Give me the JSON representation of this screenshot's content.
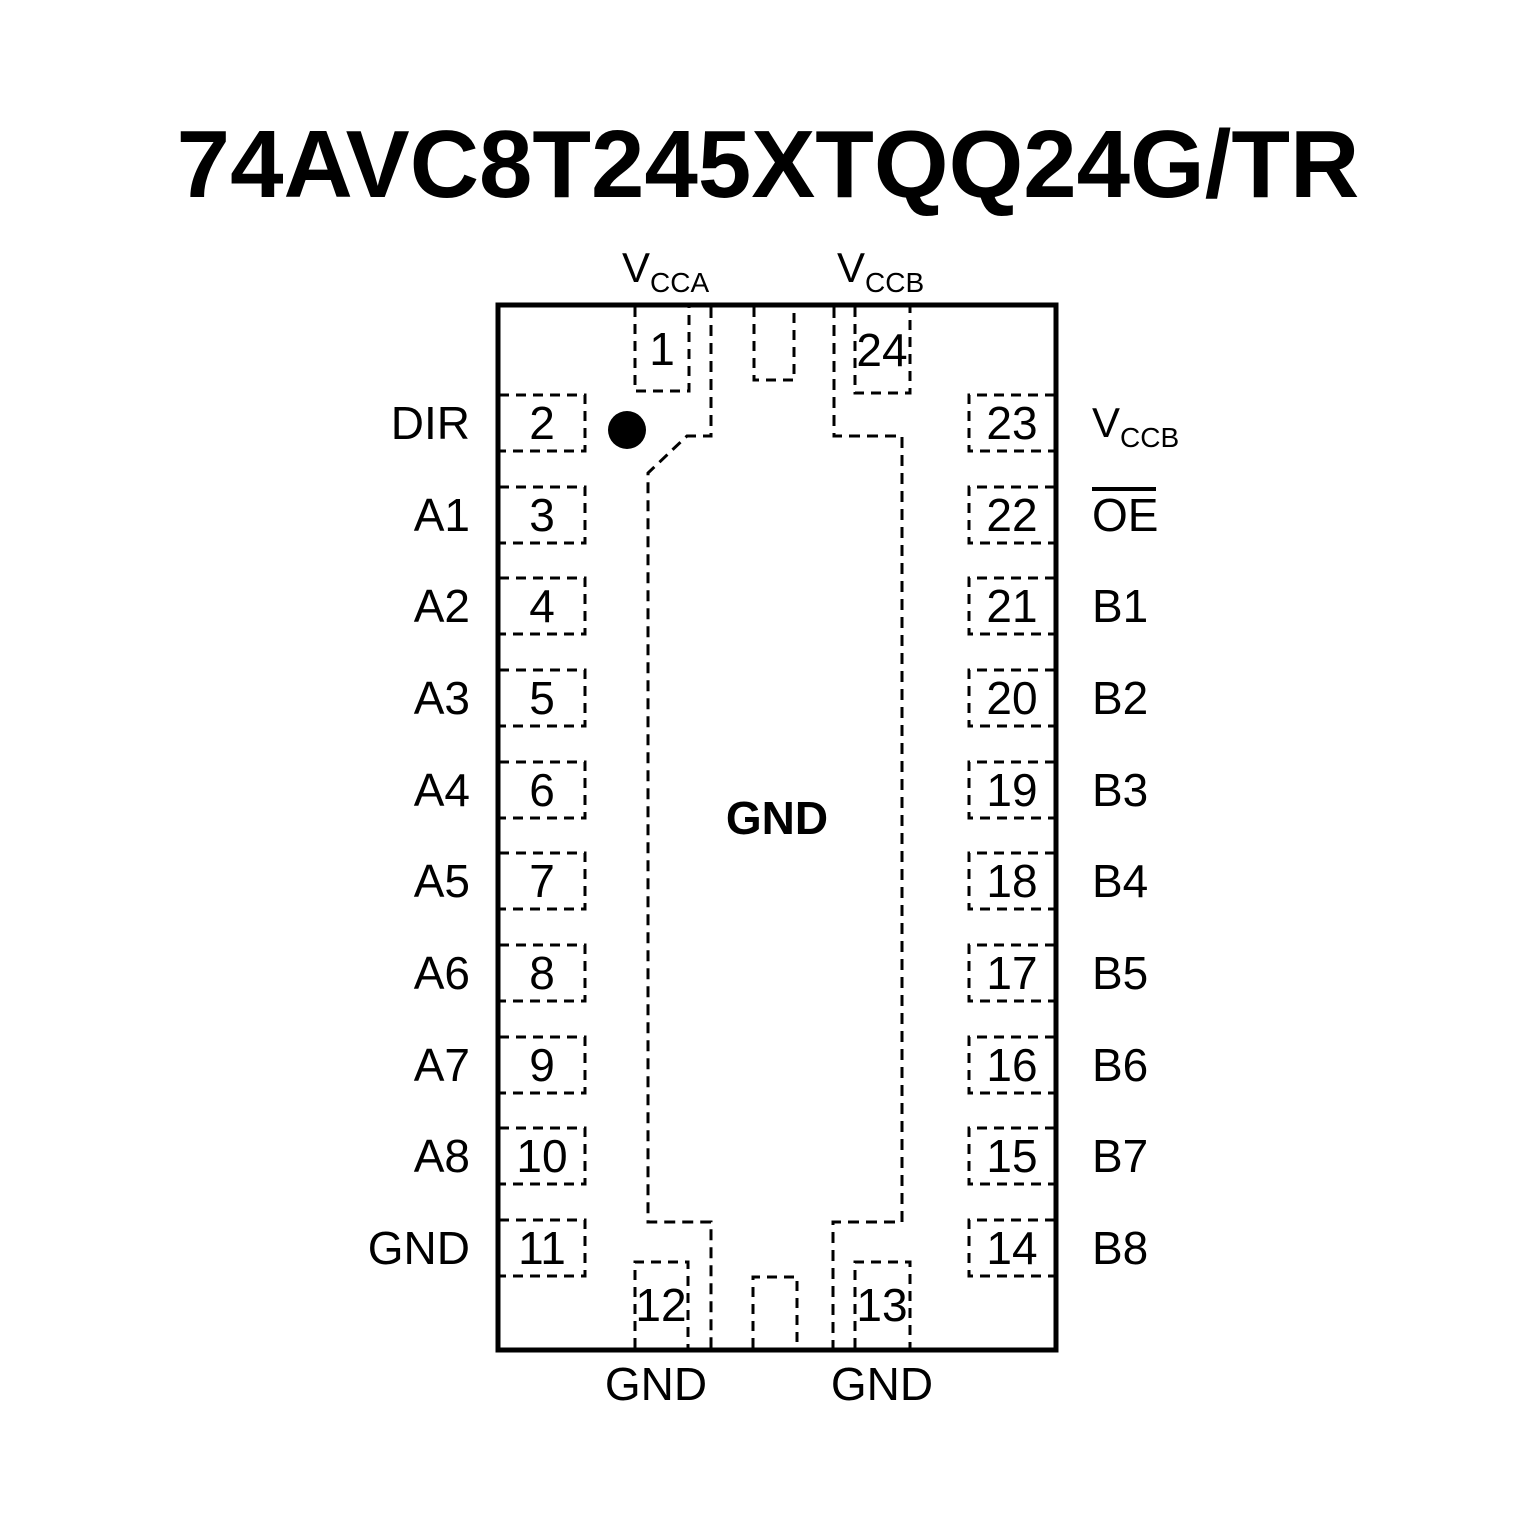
{
  "title": "74AVC8T245XTQQ24G/TR",
  "labels": {
    "vcca_top": {
      "main": "V",
      "sub": "CCA"
    },
    "vccb_top": {
      "main": "V",
      "sub": "CCB"
    },
    "center_pad": "GND"
  },
  "pins": {
    "top": [
      {
        "number": "1"
      },
      {
        "number": "24"
      }
    ],
    "left": [
      {
        "number": "2",
        "label": "DIR"
      },
      {
        "number": "3",
        "label": "A1"
      },
      {
        "number": "4",
        "label": "A2"
      },
      {
        "number": "5",
        "label": "A3"
      },
      {
        "number": "6",
        "label": "A4"
      },
      {
        "number": "7",
        "label": "A5"
      },
      {
        "number": "8",
        "label": "A6"
      },
      {
        "number": "9",
        "label": "A7"
      },
      {
        "number": "10",
        "label": "A8"
      },
      {
        "number": "11",
        "label": "GND"
      }
    ],
    "right": [
      {
        "number": "23",
        "label_main": "V",
        "label_sub": "CCB"
      },
      {
        "number": "22",
        "label": "OE",
        "overline": true
      },
      {
        "number": "21",
        "label": "B1"
      },
      {
        "number": "20",
        "label": "B2"
      },
      {
        "number": "19",
        "label": "B3"
      },
      {
        "number": "18",
        "label": "B4"
      },
      {
        "number": "17",
        "label": "B5"
      },
      {
        "number": "16",
        "label": "B6"
      },
      {
        "number": "15",
        "label": "B7"
      },
      {
        "number": "14",
        "label": "B8"
      }
    ],
    "bottom": [
      {
        "number": "12",
        "label": "GND"
      },
      {
        "number": "13",
        "label": "GND"
      }
    ]
  },
  "colors": {
    "ink": "#000000",
    "background": "#ffffff"
  }
}
